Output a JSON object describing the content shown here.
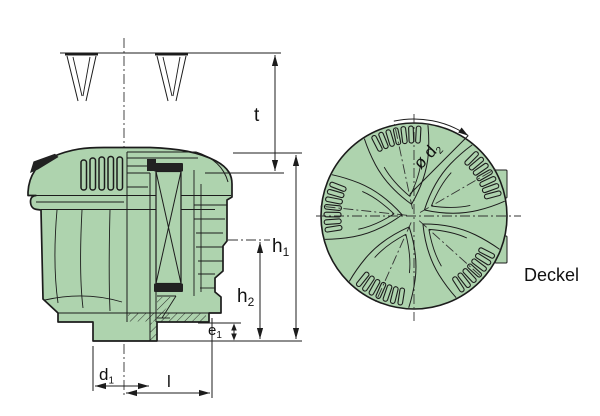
{
  "drawing": {
    "dimensions": {
      "t": {
        "base": "t",
        "sub": ""
      },
      "h1": {
        "base": "h",
        "sub": "1"
      },
      "h2": {
        "base": "h",
        "sub": "2"
      },
      "e1": {
        "base": "e",
        "sub": "1"
      },
      "d1": {
        "base": "d",
        "sub": "1"
      },
      "l": {
        "base": "l",
        "sub": ""
      },
      "d2": {
        "base": "ø d",
        "sub": "2"
      }
    },
    "top_view": {
      "caption": "Deckel",
      "petal_angles_deg": [
        30,
        102,
        174,
        246,
        318
      ],
      "slot_offsets_deg": [
        -15,
        -10,
        -5,
        0,
        5,
        10,
        15
      ]
    },
    "colors": {
      "body_fill": "#aed3ae",
      "line": "#1c1c1c",
      "centerline": "#333333"
    }
  }
}
